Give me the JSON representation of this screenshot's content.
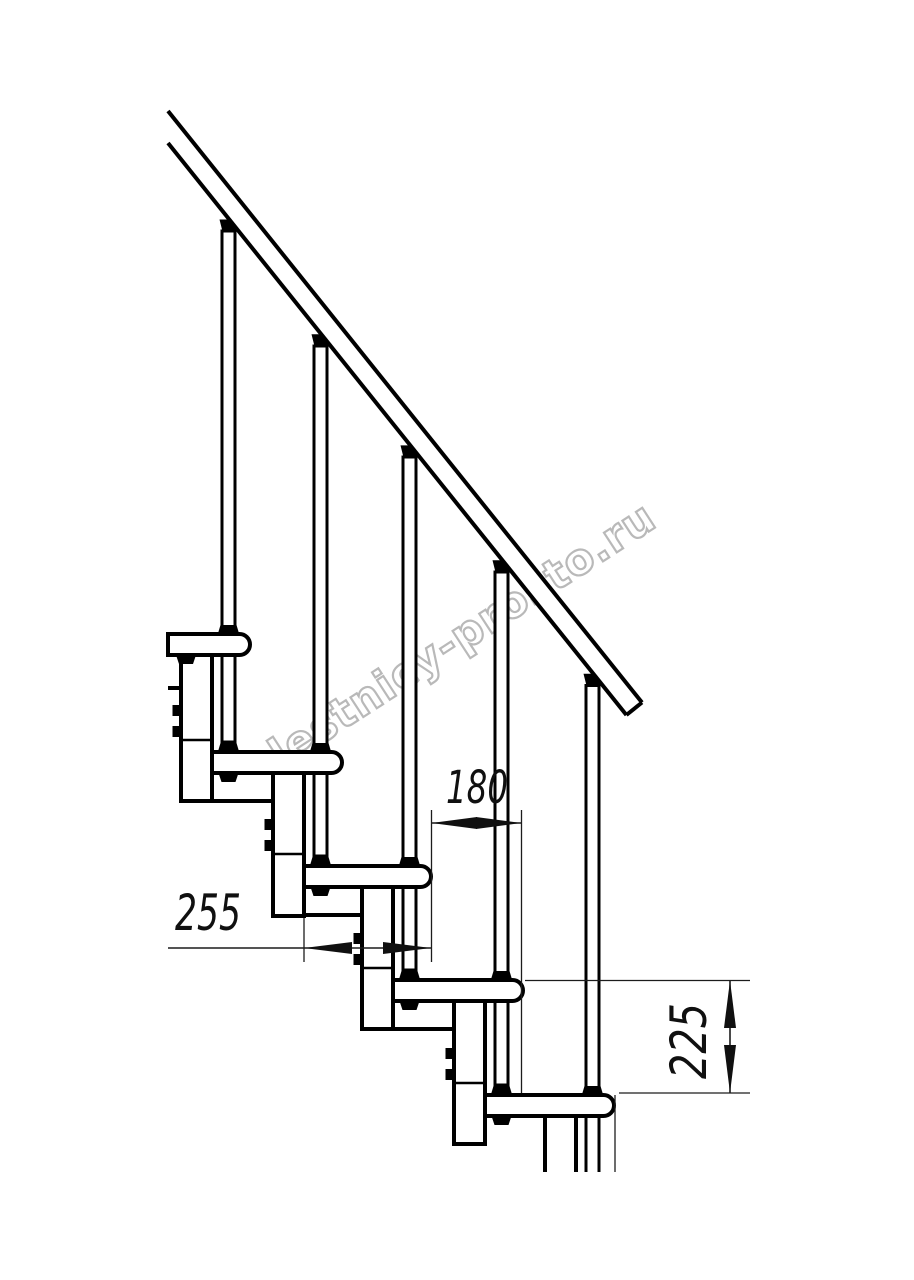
{
  "title": "Modular staircase side-elevation drawing",
  "watermark": {
    "text": "lestnicy-prosto.ru",
    "color": "#adadad"
  },
  "drawing": {
    "type": "staircase-side-elevation",
    "treads_visible": 5,
    "balusters_visible": 5,
    "line_color": "#000000",
    "background_color": "#ffffff"
  },
  "dimensions": {
    "tread_depth": {
      "label": "255"
    },
    "step_run": {
      "label": "180"
    },
    "step_rise": {
      "label": "225"
    }
  }
}
